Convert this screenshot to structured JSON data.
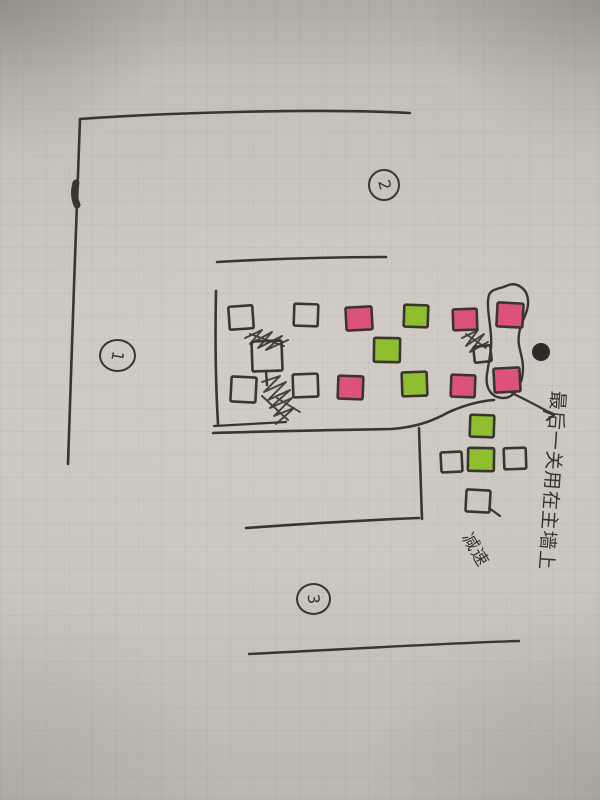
{
  "palette": {
    "paper": "#c9c4bd",
    "ink": "#3a3530",
    "pink": "#dc5377",
    "green": "#8fbf2e",
    "dot": "#2e2a27"
  },
  "markers": [
    {
      "label": "1",
      "x": 99,
      "y": 339,
      "w": 33,
      "h": 29,
      "digit_rotation": 100
    },
    {
      "label": "2",
      "x": 368,
      "y": 169,
      "w": 28,
      "h": 28,
      "digit_rotation": 75
    },
    {
      "label": "3",
      "x": 296,
      "y": 583,
      "w": 31,
      "h": 28,
      "digit_rotation": 85
    }
  ],
  "annotations": {
    "final_level": {
      "text": "最后一关用在主墙上"
    },
    "slow": {
      "text": "减速"
    }
  },
  "dot": {
    "cx": 541,
    "cy": 352,
    "r": 9
  },
  "blocks": [
    {
      "x": 229,
      "y": 306,
      "w": 24,
      "h": 23,
      "c": "outline",
      "r": -4
    },
    {
      "x": 294,
      "y": 304,
      "w": 24,
      "h": 22,
      "c": "outline",
      "r": 2
    },
    {
      "x": 346,
      "y": 307,
      "w": 26,
      "h": 23,
      "c": "pink",
      "r": -3
    },
    {
      "x": 404,
      "y": 305,
      "w": 24,
      "h": 22,
      "c": "green",
      "r": 2
    },
    {
      "x": 453,
      "y": 309,
      "w": 24,
      "h": 21,
      "c": "pink",
      "r": -2
    },
    {
      "x": 497,
      "y": 303,
      "w": 26,
      "h": 24,
      "c": "pink",
      "r": 3
    },
    {
      "x": 252,
      "y": 341,
      "w": 30,
      "h": 30,
      "c": "outline",
      "r": -2
    },
    {
      "x": 374,
      "y": 338,
      "w": 26,
      "h": 24,
      "c": "green",
      "r": 1
    },
    {
      "x": 474,
      "y": 346,
      "w": 17,
      "h": 16,
      "c": "outline",
      "r": -6
    },
    {
      "x": 231,
      "y": 377,
      "w": 25,
      "h": 25,
      "c": "outline",
      "r": 3
    },
    {
      "x": 293,
      "y": 374,
      "w": 25,
      "h": 23,
      "c": "outline",
      "r": -2
    },
    {
      "x": 338,
      "y": 376,
      "w": 25,
      "h": 23,
      "c": "pink",
      "r": 2
    },
    {
      "x": 402,
      "y": 372,
      "w": 25,
      "h": 24,
      "c": "green",
      "r": -2
    },
    {
      "x": 451,
      "y": 375,
      "w": 24,
      "h": 22,
      "c": "pink",
      "r": 2
    },
    {
      "x": 494,
      "y": 368,
      "w": 26,
      "h": 24,
      "c": "pink",
      "r": -3
    },
    {
      "x": 470,
      "y": 415,
      "w": 24,
      "h": 22,
      "c": "green",
      "r": 2
    },
    {
      "x": 441,
      "y": 452,
      "w": 21,
      "h": 20,
      "c": "outline",
      "r": -3
    },
    {
      "x": 468,
      "y": 448,
      "w": 26,
      "h": 23,
      "c": "green",
      "r": 1
    },
    {
      "x": 504,
      "y": 448,
      "w": 22,
      "h": 21,
      "c": "outline",
      "r": -2
    },
    {
      "x": 466,
      "y": 490,
      "w": 24,
      "h": 22,
      "c": "outline",
      "r": 3
    }
  ],
  "strokes": [
    {
      "name": "outer-wall-top",
      "d": "M80,119 C160,113 320,108 410,113",
      "w": 2.6
    },
    {
      "name": "outer-wall-left",
      "d": "M80,119 C76,210 71,390 68,464",
      "w": 2.6
    },
    {
      "name": "wall-blob",
      "d": "M76,183 C74,190 74,198 77,205",
      "w": 7
    },
    {
      "name": "mid-wall",
      "d": "M217,262 C270,259 330,257 386,257",
      "w": 2.6
    },
    {
      "name": "field-left-wall",
      "d": "M216,291 C215,340 216,390 218,424",
      "w": 2.6
    },
    {
      "name": "under-field-short",
      "d": "M214,426 L286,422",
      "w": 2.2
    },
    {
      "name": "under-field-curve",
      "d": "M213,433 C270,431 340,430 391,429 C420,427 436,419 449,412 C467,404 481,401 494,400",
      "w": 2.6
    },
    {
      "name": "box-right-wall",
      "d": "M419,428 C420,460 421,495 422,519",
      "w": 2.6
    },
    {
      "name": "box-bottom-wall",
      "d": "M246,528 C300,524 370,520 419,518",
      "w": 2.6
    },
    {
      "name": "bottom-long-wall",
      "d": "M249,654 C350,649 450,643 519,641",
      "w": 2.4
    },
    {
      "name": "shoe-outline",
      "d": "M506,286 C516,281 527,288 528,300 C529,313 521,320 519,334 C517,348 523,354 523,368 C523,385 514,399 502,398 C491,397 485,388 487,374 C489,360 492,350 491,336 C490,320 486,305 489,295 C491,289 499,289 506,286 Z",
      "w": 2.4
    },
    {
      "name": "arrow-shaft",
      "d": "M512,393 C528,401 542,408 554,415",
      "w": 2.2
    },
    {
      "name": "arrow-head",
      "d": "M554,415 L544,411 M554,415 L547,420",
      "w": 2.2
    },
    {
      "name": "block-stem",
      "d": "M266,371 L267,385",
      "w": 2.4
    },
    {
      "name": "slow-dash",
      "d": "M489,508 L500,516",
      "w": 2.2
    }
  ],
  "scribbles": [
    {
      "name": "scribble-row2-left",
      "d": "M245,338 L262,330 L250,344 L272,332 L258,348 L282,336 L266,350 L288,340 M250,334 L284,346"
    },
    {
      "name": "scribble-row3-left",
      "d": "M262,382 L280,376 L264,392 L286,382 L268,400 L290,390 L270,408 L292,398 L274,416 L294,408 L276,424 M277,398 L300,412 M262,396 L288,420"
    },
    {
      "name": "scribble-near-shoe",
      "d": "M462,338 L478,330 L466,346 L484,334 L470,352 L488,342 M466,334 L486,348"
    }
  ]
}
